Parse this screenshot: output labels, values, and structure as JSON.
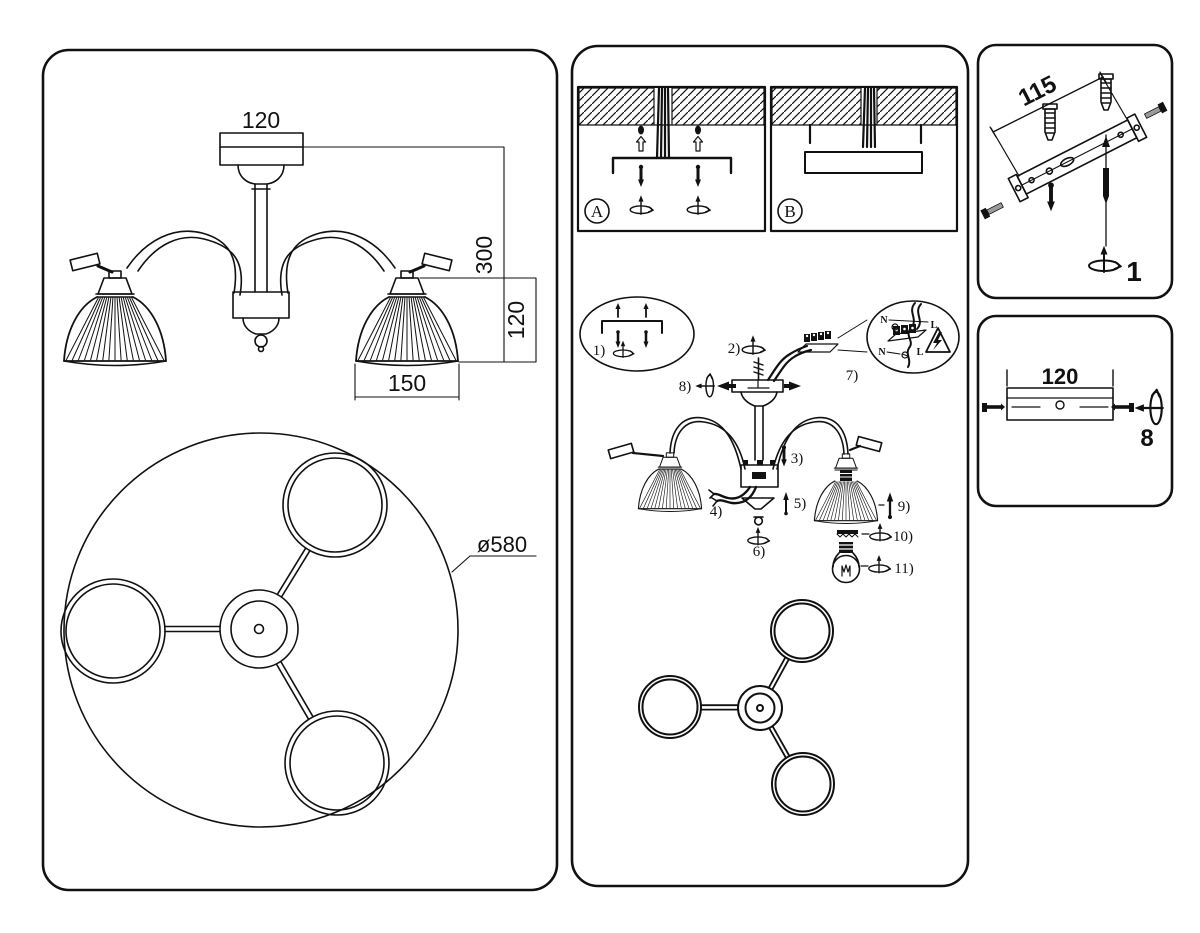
{
  "colors": {
    "ink": "#111111",
    "paper": "#ffffff",
    "screw_gray": "#9a9a9a"
  },
  "left_panel": {
    "side_view": {
      "canopy_width": "120",
      "overall_height": "300",
      "shade_height": "120",
      "shade_width": "150"
    },
    "top_view": {
      "diameter_label": "ø580"
    }
  },
  "middle_panel": {
    "step_a": {
      "label": "A"
    },
    "step_b": {
      "label": "B"
    },
    "assembly_steps": [
      "1)",
      "2)",
      "3)",
      "4)",
      "5)",
      "6)",
      "7)",
      "8)",
      "9)",
      "10)",
      "11)"
    ],
    "wiring_detail": {
      "neutral_top": "N",
      "line_top": "L",
      "neutral_bottom": "N",
      "line_bottom": "L"
    }
  },
  "right_top_panel": {
    "bracket_length": "115",
    "step_number": "1"
  },
  "right_bottom_panel": {
    "canopy_width": "120",
    "step_number": "8"
  }
}
